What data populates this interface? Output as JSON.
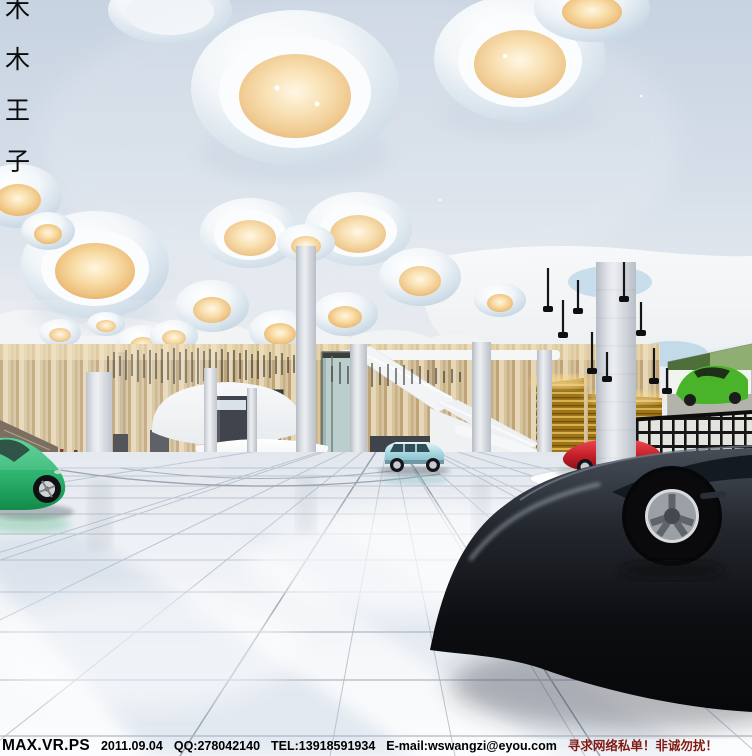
{
  "watermark": {
    "chars": [
      "木",
      "木",
      "王",
      "子"
    ]
  },
  "footer": {
    "brand": "MAX.VR.PS",
    "date": "2011.09.04",
    "qq": "QQ:278042140",
    "tel": "TEL:13918591934",
    "email": "E-mail:wswangzi@eyou.com",
    "note": "寻求网络私单！非诚勿扰！"
  },
  "scene": {
    "subject": "car showroom lobby interior rendering",
    "objects": [
      "ceiling bell light fixtures",
      "marble columns",
      "wood slat wall",
      "reception desk",
      "staircase",
      "glass elevator",
      "green sports car",
      "light blue suv",
      "red sports car on round platform",
      "black car foreground",
      "green car billboard",
      "gold slat walls"
    ]
  },
  "colors": {
    "ceiling_blue": "#cdd8e4",
    "amber_light": "#eec27f",
    "wood_light": "#e3d3b0",
    "wood_dark": "#b89a69",
    "gold_wall": "#9e7418",
    "green_car": "#2bb16b",
    "blue_suv": "#abd9e3",
    "red_car": "#c21e28",
    "black_car": "#0d0e11",
    "floor": "#eef1f5",
    "footer_text": "#000000",
    "footer_note": "#811a12"
  }
}
